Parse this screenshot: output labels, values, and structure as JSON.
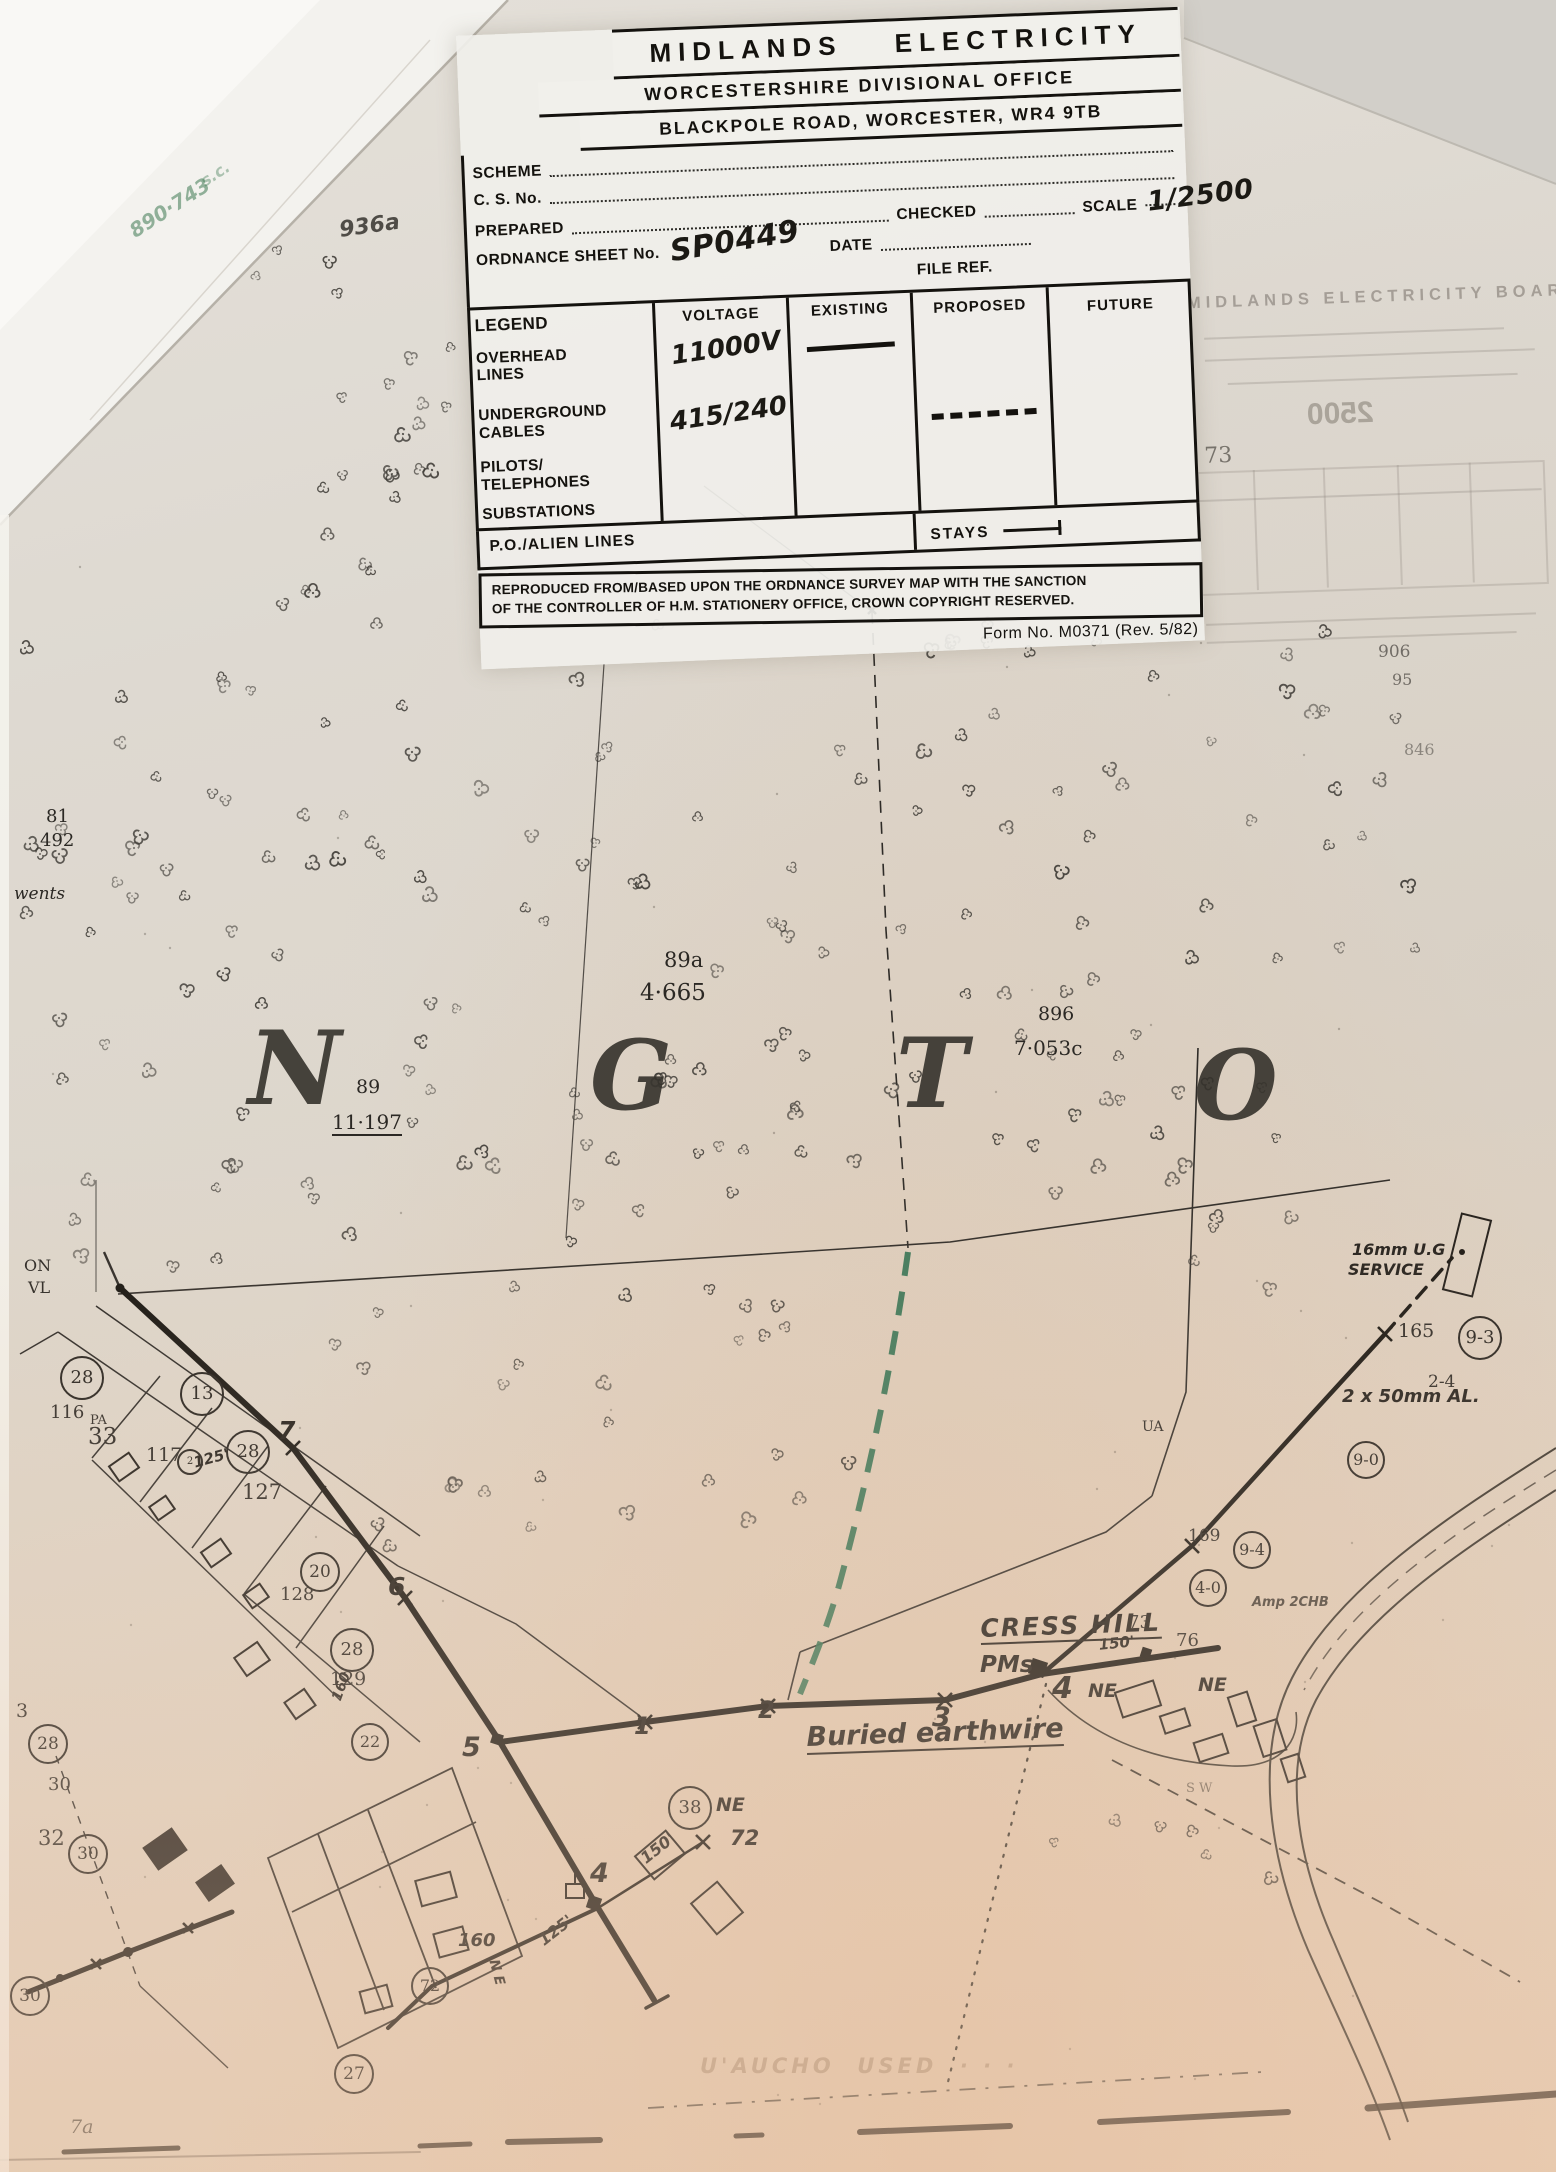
{
  "form": {
    "title": "MIDLANDS ELECTRICITY",
    "office_line": "WORCESTERSHIRE DIVISIONAL OFFICE",
    "address_line": "BLACKPOLE ROAD, WORCESTER, WR4 9TB",
    "fields": {
      "scheme_label": "SCHEME",
      "cs_no_label": "C. S. No.",
      "prepared_label": "PREPARED",
      "checked_label": "CHECKED",
      "scale_label": "SCALE",
      "scale_value": "1/2500",
      "ordnance_label": "ORDNANCE SHEET No.",
      "ordnance_value": "SP0449",
      "date_label": "DATE",
      "file_ref_label": "FILE REF."
    },
    "legend": {
      "title": "LEGEND",
      "col_voltage": "VOLTAGE",
      "col_existing": "EXISTING",
      "col_proposed": "PROPOSED",
      "col_future": "FUTURE",
      "row_overhead": "OVERHEAD LINES",
      "row_underground": "UNDERGROUND CABLES",
      "row_pilots": "PILOTS/ TELEPHONES",
      "row_substations": "SUBSTATIONS",
      "voltage_overhead": "11000V",
      "voltage_underground": "415/240",
      "po_alien_label": "P.O./ALIEN LINES",
      "stays_label": "STAYS"
    },
    "copyright_line1": "REPRODUCED FROM/BASED UPON THE ORDNANCE SURVEY MAP WITH THE SANCTION",
    "copyright_line2": "OF THE CONTROLLER OF H.M. STATIONERY OFFICE, CROWN COPYRIGHT RESERVED.",
    "form_no": "Form No. M0371 (Rev. 5/82)"
  },
  "ghost": {
    "title": "MIDLANDS  ELECTRICITY  BOARD",
    "scale_value": "2500",
    "note": "73"
  },
  "colors": {
    "paper": "#ddd6cb",
    "ink": "#14120e",
    "green_cable": "#2f7050",
    "warm_tint": "#e8c9a8"
  },
  "map": {
    "big_letters": [
      {
        "t": "N",
        "x": 248,
        "y": 1018,
        "s": 102
      },
      {
        "t": "G",
        "x": 590,
        "y": 1028,
        "s": 96
      },
      {
        "t": "T",
        "x": 896,
        "y": 1026,
        "s": 96
      },
      {
        "t": "O",
        "x": 1194,
        "y": 1038,
        "s": 96
      }
    ],
    "labels": [
      {
        "t": "81",
        "x": 46,
        "y": 808,
        "s": 18,
        "n": "parcel-number"
      },
      {
        "t": "492",
        "x": 40,
        "y": 832,
        "s": 18,
        "n": "parcel-area"
      },
      {
        "t": "wents",
        "x": 14,
        "y": 886,
        "s": 17,
        "k": "serifi",
        "n": "map-word"
      },
      {
        "t": "89a",
        "x": 664,
        "y": 950,
        "s": 21,
        "n": "parcel-number"
      },
      {
        "t": "4·665",
        "x": 640,
        "y": 982,
        "s": 23,
        "n": "parcel-area"
      },
      {
        "t": "896",
        "x": 1038,
        "y": 1005,
        "s": 19,
        "n": "parcel-number"
      },
      {
        "t": "7·053c",
        "x": 1014,
        "y": 1038,
        "s": 20,
        "n": "parcel-area"
      },
      {
        "t": "89",
        "x": 356,
        "y": 1078,
        "s": 19,
        "n": "parcel-number"
      },
      {
        "t": "11·197",
        "x": 332,
        "y": 1112,
        "s": 20,
        "u": 1,
        "n": "parcel-area"
      },
      {
        "t": "906",
        "x": 1378,
        "y": 644,
        "s": 17,
        "o": 0.6,
        "n": "parcel-number"
      },
      {
        "t": "95",
        "x": 1392,
        "y": 672,
        "s": 16,
        "o": 0.6,
        "n": "parcel-area"
      },
      {
        "t": "846",
        "x": 1404,
        "y": 742,
        "s": 16,
        "o": 0.45,
        "n": "parcel-number"
      },
      {
        "t": "ON",
        "x": 24,
        "y": 1258,
        "s": 16,
        "n": "map-word"
      },
      {
        "t": "VL",
        "x": 28,
        "y": 1280,
        "s": 16,
        "n": "map-word"
      },
      {
        "t": "116",
        "x": 50,
        "y": 1404,
        "s": 18,
        "n": "house-number"
      },
      {
        "t": "PA",
        "x": 90,
        "y": 1414,
        "s": 13,
        "n": "map-word"
      },
      {
        "t": "33",
        "x": 88,
        "y": 1426,
        "s": 23,
        "n": "house-number"
      },
      {
        "t": "117",
        "x": 146,
        "y": 1446,
        "s": 19,
        "n": "house-number"
      },
      {
        "t": "125'",
        "x": 192,
        "y": 1456,
        "s": 15,
        "r": -15,
        "k": "hand",
        "n": "span-length"
      },
      {
        "t": "127",
        "x": 242,
        "y": 1482,
        "s": 21,
        "n": "house-number"
      },
      {
        "t": "128",
        "x": 280,
        "y": 1586,
        "s": 18,
        "n": "house-number"
      },
      {
        "t": "129",
        "x": 330,
        "y": 1670,
        "s": 19,
        "n": "house-number"
      },
      {
        "t": "160'",
        "x": 330,
        "y": 1698,
        "s": 14,
        "r": -70,
        "k": "hand",
        "n": "span-length"
      },
      {
        "t": "7",
        "x": 278,
        "y": 1418,
        "s": 25,
        "k": "hand",
        "n": "pole-number"
      },
      {
        "t": "6",
        "x": 388,
        "y": 1574,
        "s": 25,
        "k": "hand",
        "n": "pole-number"
      },
      {
        "t": "5",
        "x": 462,
        "y": 1734,
        "s": 27,
        "k": "hand",
        "n": "pole-number"
      },
      {
        "t": "1",
        "x": 634,
        "y": 1714,
        "s": 24,
        "k": "hand",
        "n": "pole-number"
      },
      {
        "t": "2",
        "x": 758,
        "y": 1698,
        "s": 24,
        "k": "hand",
        "n": "pole-number"
      },
      {
        "t": "3",
        "x": 932,
        "y": 1704,
        "s": 27,
        "k": "hand",
        "n": "pole-number"
      },
      {
        "t": "4",
        "x": 1052,
        "y": 1674,
        "s": 30,
        "k": "hand",
        "n": "pole-number"
      },
      {
        "t": "NE",
        "x": 1088,
        "y": 1682,
        "s": 19,
        "k": "hand",
        "n": "map-word"
      },
      {
        "t": "NE",
        "x": 1198,
        "y": 1676,
        "s": 19,
        "k": "hand",
        "n": "map-word"
      },
      {
        "t": "73",
        "x": 1128,
        "y": 1614,
        "s": 18,
        "n": "house-number"
      },
      {
        "t": "76",
        "x": 1176,
        "y": 1632,
        "s": 18,
        "n": "house-number"
      },
      {
        "t": "150'",
        "x": 1098,
        "y": 1638,
        "s": 15,
        "r": -6,
        "k": "hand",
        "n": "span-length"
      },
      {
        "t": "CRESS HILL",
        "x": 980,
        "y": 1616,
        "s": 25,
        "k": "hand",
        "u": 1,
        "ls": 2,
        "r": -2,
        "n": "place-name"
      },
      {
        "t": "PMs",
        "x": 980,
        "y": 1654,
        "s": 23,
        "k": "hand",
        "n": "equipment-label"
      },
      {
        "t": "Buried earthwire",
        "x": 806,
        "y": 1724,
        "s": 27,
        "k": "hand",
        "u": 1,
        "r": -2,
        "n": "cable-note"
      },
      {
        "t": "16mm U.G",
        "x": 1352,
        "y": 1242,
        "s": 16,
        "k": "hand",
        "n": "service-note"
      },
      {
        "t": "SERVICE",
        "x": 1348,
        "y": 1262,
        "s": 16,
        "k": "hand",
        "n": "service-note"
      },
      {
        "t": "165",
        "x": 1398,
        "y": 1322,
        "s": 19,
        "n": "pole-id"
      },
      {
        "t": "2-4",
        "x": 1428,
        "y": 1374,
        "s": 17,
        "n": "map-number"
      },
      {
        "t": "2 x 50mm AL.",
        "x": 1342,
        "y": 1388,
        "s": 18,
        "k": "hand",
        "n": "conductor-note"
      },
      {
        "t": "169",
        "x": 1188,
        "y": 1528,
        "s": 17,
        "n": "pole-id"
      },
      {
        "t": "UA",
        "x": 1142,
        "y": 1420,
        "s": 14,
        "n": "map-word"
      },
      {
        "t": "Amp 2CHB",
        "x": 1252,
        "y": 1596,
        "s": 13,
        "k": "hand",
        "o": 0.8,
        "n": "equipment-label"
      },
      {
        "t": "S W",
        "x": 1186,
        "y": 1782,
        "s": 13,
        "o": 0.6,
        "n": "map-word"
      },
      {
        "t": "NE",
        "x": 716,
        "y": 1796,
        "s": 19,
        "k": "hand",
        "n": "map-word"
      },
      {
        "t": "72",
        "x": 730,
        "y": 1828,
        "s": 21,
        "k": "hand",
        "n": "pole-id"
      },
      {
        "t": "150'",
        "x": 638,
        "y": 1854,
        "s": 16,
        "r": -38,
        "k": "hand",
        "n": "span-length"
      },
      {
        "t": "4",
        "x": 590,
        "y": 1860,
        "s": 27,
        "k": "hand",
        "n": "pole-number"
      },
      {
        "t": "125'",
        "x": 536,
        "y": 1936,
        "s": 16,
        "r": -38,
        "k": "hand",
        "n": "span-length"
      },
      {
        "t": "160",
        "x": 458,
        "y": 1932,
        "s": 18,
        "k": "hand",
        "n": "map-number"
      },
      {
        "t": "N E",
        "x": 500,
        "y": 1958,
        "s": 14,
        "r": 75,
        "k": "hand",
        "n": "map-word"
      },
      {
        "t": "3",
        "x": 16,
        "y": 1702,
        "s": 19,
        "n": "map-number"
      },
      {
        "t": "30",
        "x": 48,
        "y": 1776,
        "s": 18,
        "n": "map-number"
      },
      {
        "t": "32",
        "x": 38,
        "y": 1828,
        "s": 21,
        "n": "map-number"
      },
      {
        "t": "7a",
        "x": 70,
        "y": 2118,
        "s": 19,
        "o": 0.7,
        "k": "serifi",
        "n": "map-number"
      },
      {
        "t": "U'AUCHO  USED  · · ·",
        "x": 700,
        "y": 2056,
        "s": 21,
        "o": 0.38,
        "k": "hand",
        "ls": 4,
        "c": "#7a5c42",
        "n": "faint-ghost-text"
      },
      {
        "t": "936a",
        "x": 338,
        "y": 220,
        "s": 22,
        "r": -8,
        "o": 0.75,
        "k": "hand",
        "n": "margin-note"
      },
      {
        "t": "890·743",
        "x": 126,
        "y": 224,
        "s": 20,
        "r": -33,
        "o": 0.55,
        "k": "hand",
        "c": "#3f7a52",
        "n": "green-pencil-note"
      },
      {
        "t": "s.c.",
        "x": 198,
        "y": 176,
        "s": 16,
        "r": -33,
        "o": 0.4,
        "k": "hand",
        "c": "#3f7a52",
        "n": "green-pencil-note"
      }
    ],
    "circles": [
      {
        "t": "28",
        "x": 80,
        "y": 1376,
        "d": 40
      },
      {
        "t": "13",
        "x": 200,
        "y": 1392,
        "d": 40
      },
      {
        "t": "28",
        "x": 246,
        "y": 1450,
        "d": 40
      },
      {
        "t": "2",
        "x": 188,
        "y": 1460,
        "d": 22
      },
      {
        "t": "20",
        "x": 318,
        "y": 1570,
        "d": 36
      },
      {
        "t": "28",
        "x": 350,
        "y": 1648,
        "d": 40
      },
      {
        "t": "22",
        "x": 368,
        "y": 1740,
        "d": 34
      },
      {
        "t": "28",
        "x": 46,
        "y": 1742,
        "d": 36
      },
      {
        "t": "30",
        "x": 86,
        "y": 1852,
        "d": 36
      },
      {
        "t": "30",
        "x": 28,
        "y": 1994,
        "d": 36
      },
      {
        "t": "27",
        "x": 352,
        "y": 2072,
        "d": 36
      },
      {
        "t": "38",
        "x": 688,
        "y": 1806,
        "d": 40
      },
      {
        "t": "72",
        "x": 428,
        "y": 1984,
        "d": 34
      },
      {
        "t": "9-3",
        "x": 1478,
        "y": 1336,
        "d": 40
      },
      {
        "t": "9-0",
        "x": 1364,
        "y": 1458,
        "d": 34
      },
      {
        "t": "9-4",
        "x": 1250,
        "y": 1548,
        "d": 34
      },
      {
        "t": "4-0",
        "x": 1206,
        "y": 1586,
        "d": 34
      }
    ],
    "poles": {
      "xmarks": [
        [
          293,
          1448
        ],
        [
          405,
          1598
        ],
        [
          645,
          1722
        ],
        [
          768,
          1706
        ],
        [
          945,
          1700
        ],
        [
          1192,
          1546
        ],
        [
          1385,
          1334
        ],
        [
          703,
          1842
        ],
        [
          96,
          1964,
          5
        ],
        [
          188,
          1928,
          5
        ],
        [
          872,
          610,
          4
        ]
      ],
      "squares": [
        [
          497,
          1739,
          11
        ],
        [
          1038,
          1668,
          16
        ],
        [
          594,
          1903,
          13
        ],
        [
          1146,
          1653,
          10
        ]
      ],
      "dots": [
        [
          120,
          1288,
          4.5
        ],
        [
          128,
          1952,
          5
        ],
        [
          60,
          1978,
          4
        ],
        [
          1462,
          1252,
          3
        ]
      ]
    },
    "tree_regions": [
      {
        "x0": 235,
        "y0": 215,
        "x1": 465,
        "y1": 600,
        "n": 26
      },
      {
        "x0": 20,
        "y0": 600,
        "x1": 1430,
        "y1": 1020,
        "n": 112
      },
      {
        "x0": 20,
        "y0": 1020,
        "x1": 1300,
        "y1": 1290,
        "n": 72
      },
      {
        "x0": 300,
        "y0": 1290,
        "x1": 900,
        "y1": 1545,
        "n": 26
      },
      {
        "x0": 1040,
        "y0": 1800,
        "x1": 1280,
        "y1": 1890,
        "n": 6
      }
    ]
  }
}
